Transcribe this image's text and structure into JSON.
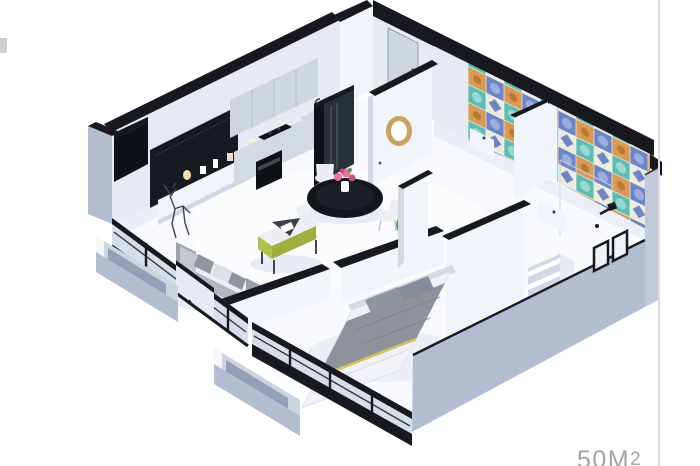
{
  "page": {
    "background": "#ffffff",
    "area_label_value": "50M",
    "area_label_sup": "2"
  },
  "render": {
    "subject": "3D isometric cutaway rendering of a one-bedroom apartment floor plan"
  },
  "palette": {
    "bg": "#ffffff",
    "cap": "#17191e",
    "wall_light": "#f1f4f8",
    "wall_mid": "#e6ebf2",
    "wall_shade": "#d2d8e3",
    "floor": "#f8f9fc",
    "floor_shadow": "#e7ebf3",
    "exterior": "#b3bdd0",
    "exterior_light": "#ccd4e2",
    "exterior_shade": "#96a0b5",
    "glass": "#d7deea",
    "tv": "#171b21",
    "cabinet": "#cfd6de",
    "cabinet_line": "#b9c1ca",
    "counter_front": "#d4dae2",
    "counter_top": "#edf0f5",
    "appliance_dark": "#0e1116",
    "fridge_front": "#2a303a",
    "table_black": "#12151b",
    "chair": "#eceef2",
    "sofa": "#c3c7ce",
    "sofa_shade": "#9aa0aa",
    "pillow": "#8f959f",
    "accent_lime": "#b0c04a",
    "blanket": "#8d929b",
    "sheet": "#f1f2f5",
    "headboard": "#d6dae2",
    "stripe_yellow": "#cfc35e",
    "tile_teal": "#5fbcb2",
    "tile_light": "#ecebdd",
    "tile_orange": "#d89a55",
    "tile_blue": "#6d86c3",
    "gold": "#c8a35f",
    "plant": "#5d9a50",
    "plant_dark": "#3f7a3a",
    "flower": "#e2739c",
    "flower_deep": "#c44f82",
    "glow": "#fff3cf",
    "label": "#a3a3a3",
    "rule": "#dcdcdc",
    "tab": "#cfcfcf"
  }
}
